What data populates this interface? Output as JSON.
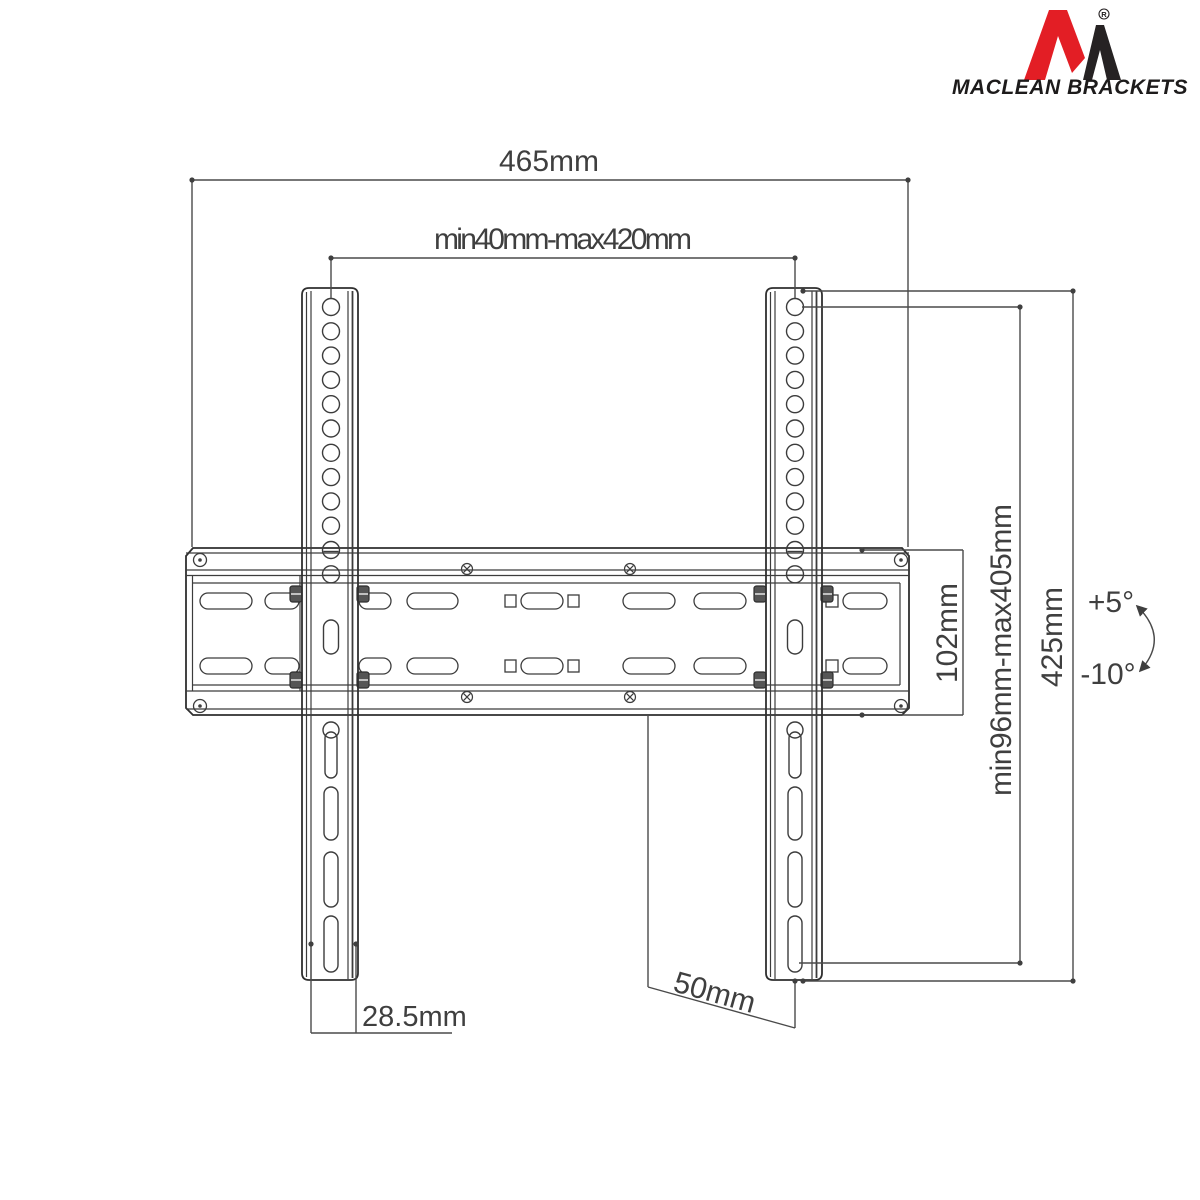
{
  "logo": {
    "brand": "MACLEAN BRACKETS",
    "registered_mark": "R",
    "colors": {
      "red": "#e31e25",
      "dark": "#262223"
    }
  },
  "drawing": {
    "ink_color": "#2f2f2f",
    "dimensions": {
      "overall_width": "465mm",
      "vesa_width_range": "min40mm-max420mm",
      "plate_height": "102mm",
      "vesa_height_range": "min96mm-max405mm",
      "bracket_height": "425mm",
      "tilt_up": "+5°",
      "tilt_down": "-10°",
      "rail_width": "28.5mm",
      "wall_offset": "50mm"
    }
  }
}
